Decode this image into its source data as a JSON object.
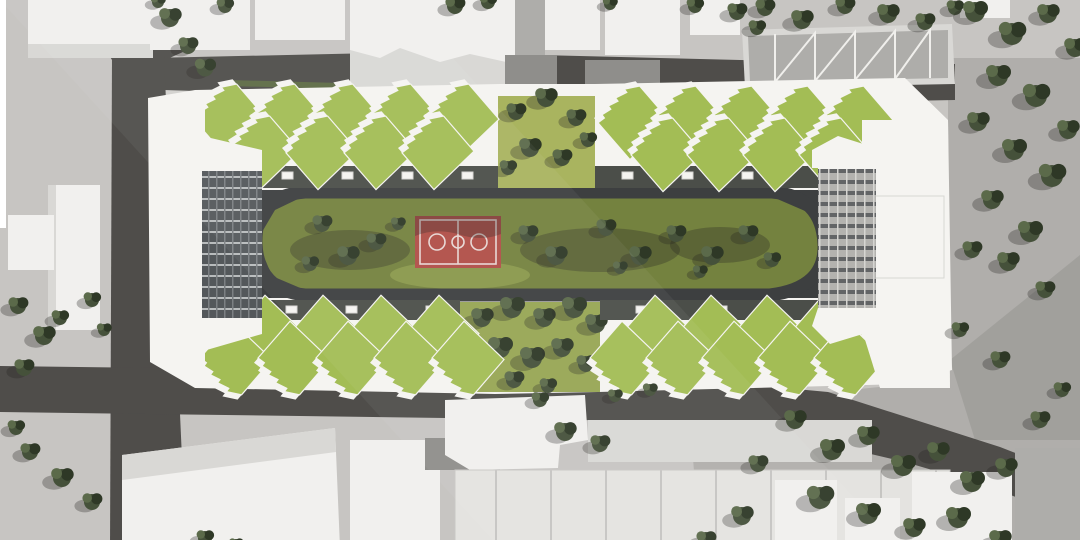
{
  "scene": {
    "description": "Aerial architectural rendering: elongated residential block with sawtooth green roofs and end towers around a courtyard with lawn, trees and a red basketball court, bounded by gray roads and neighboring white buildings",
    "basketball_court": {
      "x": 415,
      "y": 216,
      "w": 86,
      "h": 52
    }
  },
  "colors": {
    "ground": "#c7c5c2",
    "ground_light": "#d2d1ce",
    "plaza_right": "#b0aeab",
    "plaza_shade": "#9e9c99",
    "road": "#4f4d4a",
    "road_dark": "#434140",
    "bldg_white": "#f1f0ee",
    "bldg_side": "#d9d8d5",
    "roof_gray": "#aeadaa",
    "roof_gray_dark": "#8f8e8b",
    "roof_green": "#a3bd55",
    "roof_white": "#f5f4f1",
    "lawn": "#74823f",
    "lawn_light": "#a9b45f",
    "lawn_mid": "#97a654",
    "path": "#3d3f40",
    "facade_dark": "#4b4e49",
    "tree1": "#2e3826",
    "tree2": "#45513a",
    "tree3": "#5b6a4a",
    "hedge": "#5d6b45",
    "court_red": "#b04e47",
    "court_line": "#e8d7d4",
    "frame": "#ffffff"
  },
  "teeth": {
    "top_outer": [
      [
        195,
        92
      ],
      [
        253,
        92
      ],
      [
        311,
        92
      ],
      [
        369,
        92
      ],
      [
        427,
        92
      ],
      [
        598,
        94
      ],
      [
        654,
        94
      ],
      [
        710,
        94
      ],
      [
        766,
        94
      ],
      [
        822,
        94
      ]
    ],
    "top_inner": [
      [
        228,
        124
      ],
      [
        286,
        124
      ],
      [
        344,
        124
      ],
      [
        402,
        124
      ],
      [
        631,
        126
      ],
      [
        687,
        126
      ],
      [
        743,
        126
      ],
      [
        799,
        126
      ]
    ],
    "bottom_inner": [
      [
        233,
        300
      ],
      [
        291,
        300
      ],
      [
        349,
        300
      ],
      [
        407,
        300
      ],
      [
        623,
        300
      ],
      [
        679,
        300
      ],
      [
        735,
        300
      ],
      [
        791,
        300
      ]
    ],
    "bottom_outer": [
      [
        200,
        326
      ],
      [
        258,
        326
      ],
      [
        316,
        326
      ],
      [
        374,
        326
      ],
      [
        432,
        326
      ],
      [
        590,
        326
      ],
      [
        646,
        326
      ],
      [
        702,
        326
      ],
      [
        758,
        326
      ],
      [
        814,
        326
      ]
    ]
  },
  "trees": [
    [
      170,
      18,
      0.9
    ],
    [
      188,
      46,
      0.8
    ],
    [
      205,
      68,
      0.85
    ],
    [
      225,
      6,
      0.7
    ],
    [
      158,
      2,
      0.6
    ],
    [
      455,
      6,
      0.8
    ],
    [
      488,
      2,
      0.7
    ],
    [
      610,
      4,
      0.6
    ],
    [
      695,
      6,
      0.7
    ],
    [
      737,
      12,
      0.8
    ],
    [
      757,
      28,
      0.7
    ],
    [
      765,
      8,
      0.8
    ],
    [
      802,
      20,
      0.9
    ],
    [
      845,
      6,
      0.8
    ],
    [
      888,
      14,
      0.9
    ],
    [
      925,
      22,
      0.8
    ],
    [
      955,
      8,
      0.7
    ],
    [
      975,
      12,
      1
    ],
    [
      1012,
      34,
      1.1
    ],
    [
      1048,
      14,
      0.9
    ],
    [
      1075,
      48,
      0.9
    ],
    [
      998,
      76,
      1
    ],
    [
      1036,
      96,
      1.1
    ],
    [
      978,
      122,
      0.9
    ],
    [
      1014,
      150,
      1
    ],
    [
      1052,
      176,
      1.1
    ],
    [
      1068,
      130,
      0.9
    ],
    [
      992,
      200,
      0.9
    ],
    [
      1030,
      232,
      1
    ],
    [
      972,
      250,
      0.8
    ],
    [
      1008,
      262,
      0.9
    ],
    [
      1045,
      290,
      0.8
    ],
    [
      960,
      330,
      0.7
    ],
    [
      1000,
      360,
      0.8
    ],
    [
      795,
      420,
      0.9
    ],
    [
      832,
      450,
      1
    ],
    [
      868,
      436,
      0.9
    ],
    [
      903,
      466,
      1
    ],
    [
      938,
      452,
      0.9
    ],
    [
      972,
      482,
      1
    ],
    [
      1006,
      468,
      0.9
    ],
    [
      758,
      464,
      0.8
    ],
    [
      820,
      498,
      1.1
    ],
    [
      868,
      514,
      1
    ],
    [
      914,
      528,
      0.9
    ],
    [
      958,
      518,
      1
    ],
    [
      1000,
      540,
      0.9
    ],
    [
      742,
      516,
      0.9
    ],
    [
      706,
      540,
      0.8
    ],
    [
      1040,
      420,
      0.8
    ],
    [
      1062,
      390,
      0.7
    ],
    [
      565,
      432,
      0.9
    ],
    [
      600,
      444,
      0.8
    ],
    [
      540,
      400,
      0.7
    ],
    [
      615,
      396,
      0.6
    ],
    [
      650,
      390,
      0.6
    ],
    [
      18,
      306,
      0.8
    ],
    [
      44,
      336,
      0.9
    ],
    [
      24,
      368,
      0.8
    ],
    [
      60,
      318,
      0.7
    ],
    [
      92,
      300,
      0.7
    ],
    [
      104,
      330,
      0.6
    ],
    [
      30,
      452,
      0.8
    ],
    [
      62,
      478,
      0.9
    ],
    [
      92,
      502,
      0.8
    ],
    [
      16,
      428,
      0.7
    ],
    [
      205,
      538,
      0.7
    ],
    [
      236,
      545,
      0.6
    ]
  ],
  "courtyard_trees": [
    [
      516,
      112,
      0.8
    ],
    [
      546,
      98,
      0.9
    ],
    [
      576,
      118,
      0.8
    ],
    [
      530,
      148,
      0.9
    ],
    [
      562,
      158,
      0.8
    ],
    [
      588,
      140,
      0.7
    ],
    [
      508,
      168,
      0.7
    ],
    [
      482,
      318,
      0.9
    ],
    [
      512,
      308,
      1
    ],
    [
      544,
      318,
      0.9
    ],
    [
      574,
      308,
      1
    ],
    [
      596,
      324,
      0.9
    ],
    [
      500,
      348,
      1
    ],
    [
      532,
      358,
      1
    ],
    [
      562,
      348,
      0.9
    ],
    [
      586,
      364,
      0.8
    ],
    [
      514,
      380,
      0.8
    ],
    [
      548,
      386,
      0.7
    ],
    [
      322,
      224,
      0.8
    ],
    [
      348,
      256,
      0.9
    ],
    [
      310,
      264,
      0.7
    ],
    [
      376,
      242,
      0.8
    ],
    [
      398,
      224,
      0.6
    ],
    [
      528,
      234,
      0.8
    ],
    [
      556,
      256,
      0.9
    ],
    [
      606,
      228,
      0.8
    ],
    [
      640,
      256,
      0.9
    ],
    [
      676,
      234,
      0.8
    ],
    [
      712,
      256,
      0.9
    ],
    [
      748,
      234,
      0.8
    ],
    [
      772,
      260,
      0.7
    ],
    [
      700,
      272,
      0.6
    ],
    [
      620,
      268,
      0.6
    ]
  ]
}
